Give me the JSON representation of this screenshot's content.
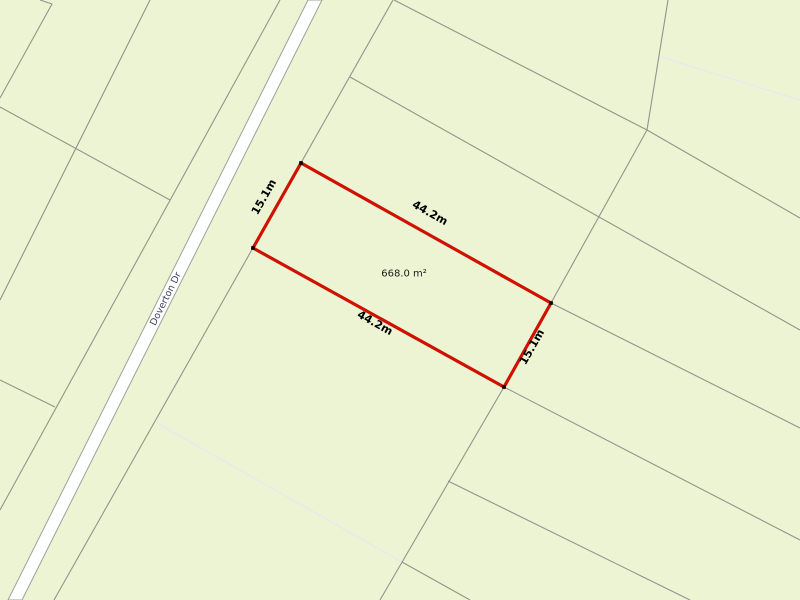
{
  "map": {
    "background_color": "#edf4d4",
    "boundary_color": "#8e968a",
    "faint_boundary_color": "#e4ebee",
    "road": {
      "fill": "#ffffff",
      "border_color": "#9ba295",
      "outline": [
        [
          308,
          0
        ],
        [
          322,
          0
        ],
        [
          22,
          600
        ],
        [
          8,
          600
        ]
      ],
      "label": {
        "text": "Doverton Dr",
        "x": 166,
        "y": 299,
        "rotation": -63.5,
        "color": "#41435f",
        "size": 9.5
      }
    },
    "boundaries": [
      {
        "name": "road-frontage-line",
        "points": [
          [
            393,
            0
          ],
          [
            54,
            600
          ]
        ]
      },
      {
        "name": "boundary-a",
        "points": [
          [
            394,
            0
          ],
          [
            647,
            130
          ],
          [
            800,
            218
          ]
        ]
      },
      {
        "name": "rear-boundary-upper",
        "points": [
          [
            668,
            0
          ],
          [
            647,
            130
          ],
          [
            551,
            303
          ]
        ]
      },
      {
        "name": "rear-boundary-lower",
        "points": [
          [
            504,
            387
          ],
          [
            380,
            600
          ]
        ]
      },
      {
        "name": "boundary-c",
        "points": [
          [
            350,
            77
          ],
          [
            800,
            330
          ]
        ]
      },
      {
        "name": "boundary-d",
        "points": [
          [
            551,
            303
          ],
          [
            800,
            428
          ]
        ]
      },
      {
        "name": "boundary-e",
        "points": [
          [
            504,
            387
          ],
          [
            800,
            540
          ]
        ]
      },
      {
        "name": "boundary-f",
        "points": [
          [
            448,
            481
          ],
          [
            690,
            600
          ]
        ]
      },
      {
        "name": "boundary-g",
        "points": [
          [
            402,
            562
          ],
          [
            470,
            600
          ]
        ]
      },
      {
        "name": "west-corner-notch",
        "points": [
          [
            40,
            0
          ],
          [
            52,
            4
          ],
          [
            0,
            98
          ]
        ]
      },
      {
        "name": "west-parallel-boundary",
        "points": [
          [
            150,
            0
          ],
          [
            0,
            300
          ]
        ]
      },
      {
        "name": "west-roadside-boundary",
        "points": [
          [
            280,
            0
          ],
          [
            0,
            510
          ]
        ]
      },
      {
        "name": "west-cross-boundary-1",
        "points": [
          [
            0,
            107
          ],
          [
            170,
            200
          ]
        ]
      },
      {
        "name": "west-cross-boundary-2",
        "points": [
          [
            0,
            380
          ],
          [
            55,
            407
          ]
        ]
      }
    ],
    "faint_boundaries": [
      {
        "name": "faint-boundary-1",
        "points": [
          [
            157,
            423
          ],
          [
            402,
            562
          ]
        ]
      },
      {
        "name": "faint-boundary-2",
        "points": [
          [
            661,
            57
          ],
          [
            800,
            100
          ]
        ]
      }
    ],
    "highlight_parcel": {
      "outline_color": "#cf1200",
      "stroke_width": 3.2,
      "corners": [
        [
          301,
          163
        ],
        [
          551,
          303
        ],
        [
          504,
          387
        ],
        [
          253,
          248
        ]
      ],
      "corner_marker_color": "#000000",
      "corner_marker_size": 3.6,
      "area_label": {
        "text": "668.0 m²",
        "x": 404,
        "y": 274,
        "size": 10,
        "color": "#1c1c1c"
      },
      "dimension_labels": [
        {
          "text": "15.1m",
          "x": 264,
          "y": 197,
          "rotation": -60.5,
          "size": 11,
          "color": "#000000"
        },
        {
          "text": "44.2m",
          "x": 430,
          "y": 213,
          "rotation": 29.2,
          "size": 11,
          "color": "#000000"
        },
        {
          "text": "44.2m",
          "x": 375,
          "y": 323,
          "rotation": 29.2,
          "size": 11,
          "color": "#000000"
        },
        {
          "text": "15.1m",
          "x": 532,
          "y": 347,
          "rotation": -60.5,
          "size": 11,
          "color": "#000000"
        }
      ]
    }
  }
}
